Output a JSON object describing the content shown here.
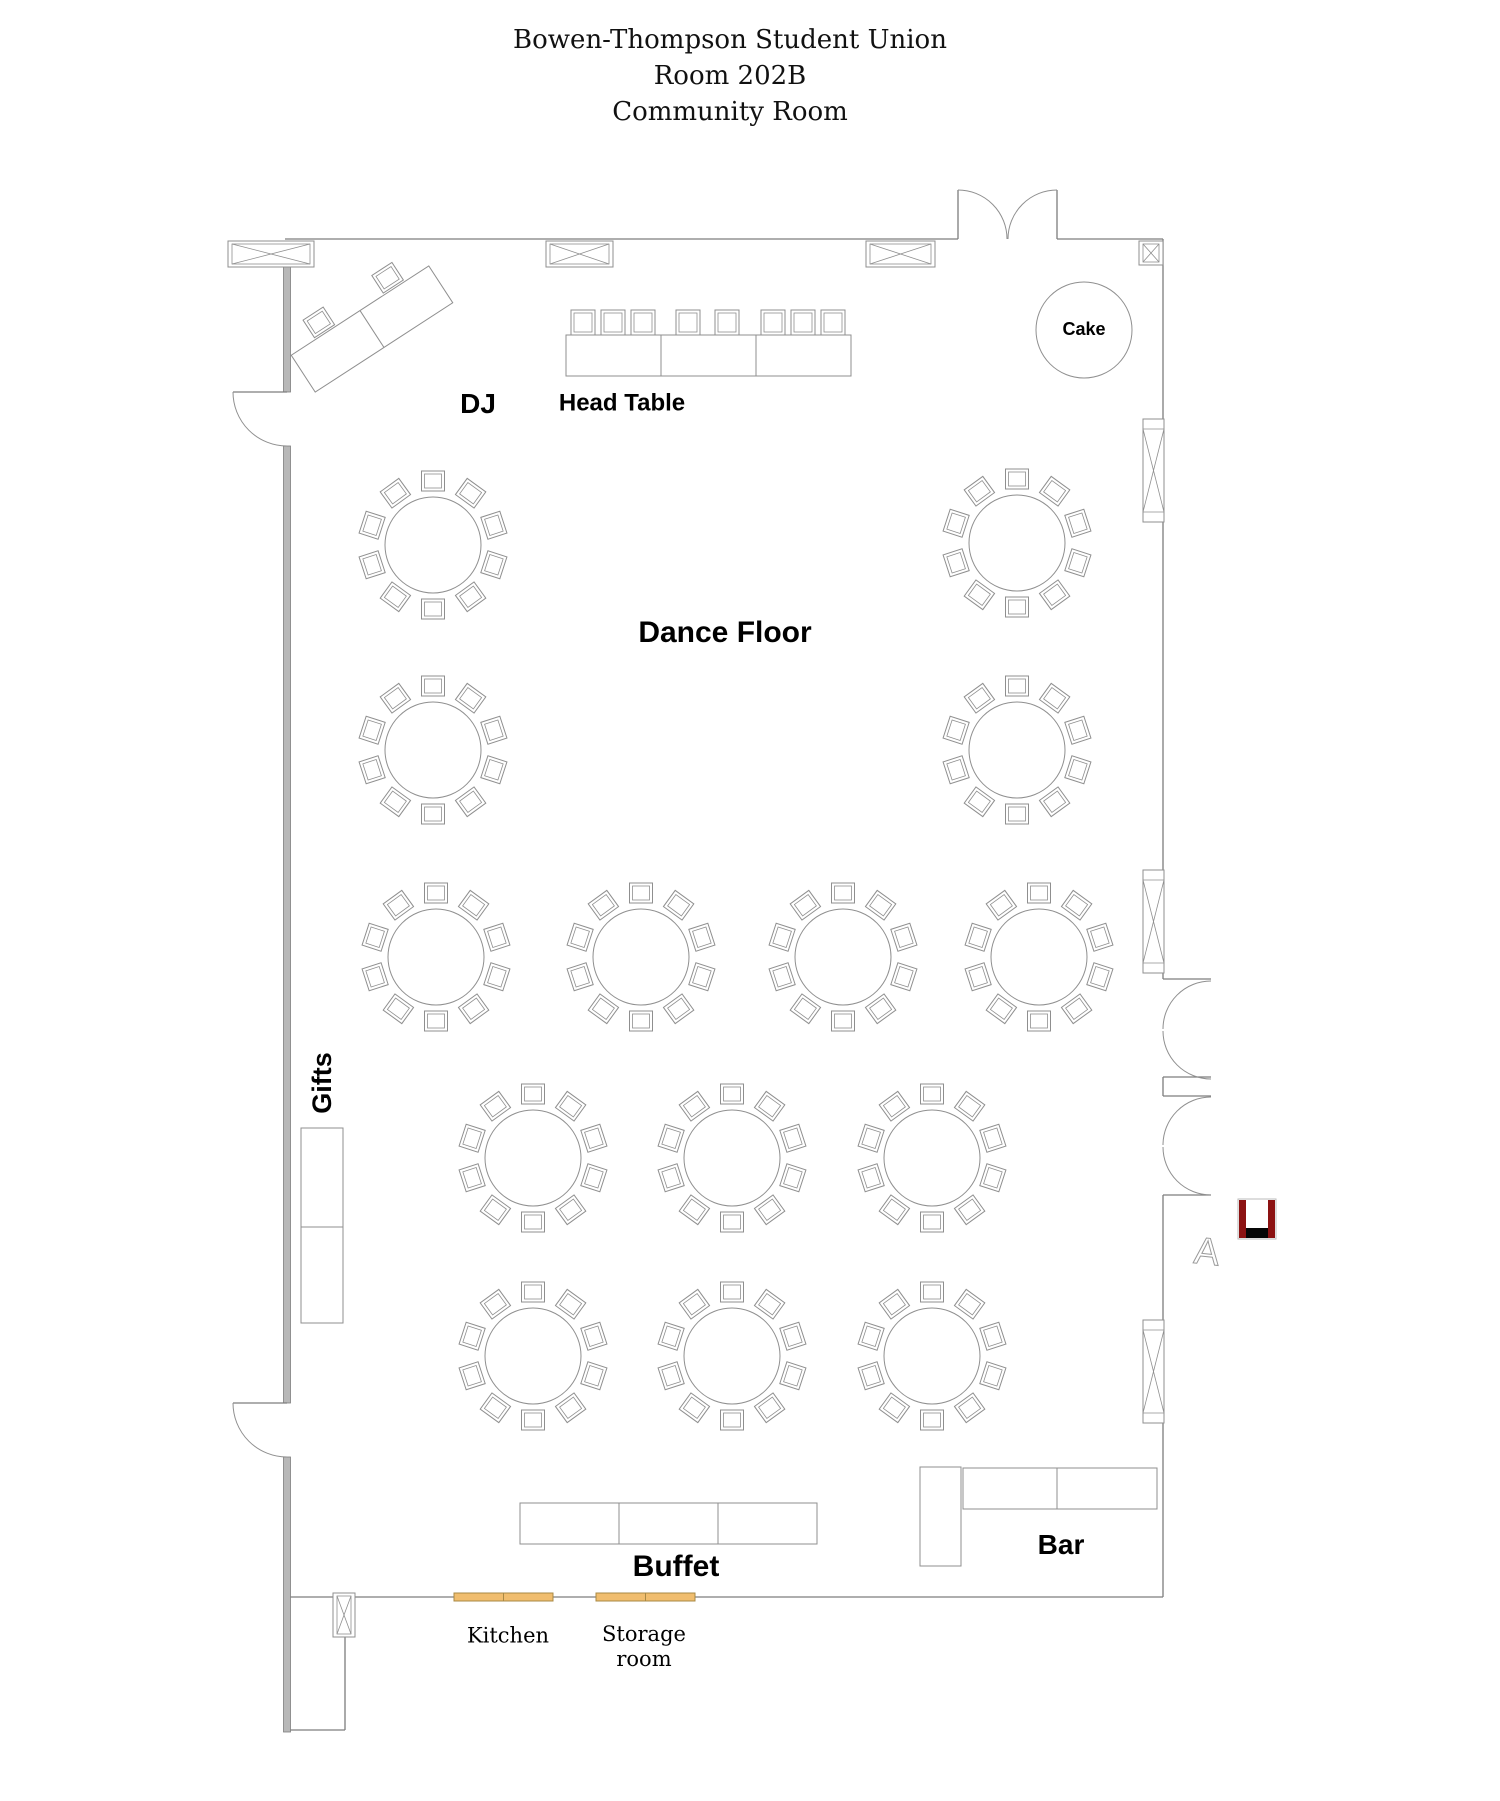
{
  "title": {
    "line1": "Bowen-Thompson Student Union",
    "line2": "Room 202B",
    "line3": "Community Room"
  },
  "labels": {
    "dj": "DJ",
    "head_table": "Head Table",
    "cake": "Cake",
    "dance_floor": "Dance Floor",
    "gifts": "Gifts",
    "buffet": "Buffet",
    "bar": "Bar",
    "kitchen": "Kitchen",
    "storage_room": "Storage\nroom",
    "a_marker_glyph": "A"
  },
  "colors": {
    "furniture_stroke": "#8f8f8f",
    "wall_stroke": "#7d7d7d",
    "thick_wall_fill": "#b8b8b8",
    "kitchen_door_fill": "#f0bd6e",
    "kitchen_door_border": "#a98944",
    "exit_marker_red": "#8c1212",
    "exit_marker_black": "#060606",
    "a_marker_color": "#9a9a9a"
  },
  "floor_plan": {
    "walls": [
      [
        285,
        239,
        958,
        239
      ],
      [
        1057,
        239,
        1163,
        239
      ],
      [
        1163,
        239,
        1163,
        979
      ],
      [
        1163,
        979,
        1211,
        979
      ],
      [
        1163,
        1077,
        1211,
        1077
      ],
      [
        1163,
        1077,
        1163,
        1096
      ],
      [
        1163,
        1096,
        1211,
        1096
      ],
      [
        1211,
        1195,
        1163,
        1195
      ],
      [
        1163,
        1195,
        1163,
        1597
      ],
      [
        1163,
        1597,
        288,
        1597
      ],
      [
        345,
        1637,
        345,
        1730
      ],
      [
        345,
        1730,
        288,
        1730
      ]
    ],
    "thick_wall": {
      "x": 283.5,
      "w": 7,
      "segments": [
        [
          267,
          392
        ],
        [
          446,
          1403
        ],
        [
          1457,
          1732
        ]
      ]
    },
    "columns": [
      {
        "x": 228,
        "y": 241,
        "w": 86,
        "h": 26
      },
      {
        "x": 546,
        "y": 241,
        "w": 67,
        "h": 26
      },
      {
        "x": 866,
        "y": 241,
        "w": 69,
        "h": 26
      },
      {
        "x": 1139,
        "y": 241,
        "w": 24,
        "h": 24
      },
      {
        "x": 333,
        "y": 1593,
        "w": 22,
        "h": 44
      }
    ],
    "windows": [
      {
        "x": 1143,
        "y": 419,
        "w": 21,
        "h": 103
      },
      {
        "x": 1143,
        "y": 870,
        "w": 21,
        "h": 103
      },
      {
        "x": 1143,
        "y": 1320,
        "w": 21,
        "h": 103
      }
    ],
    "door_lines": [
      [
        958,
        190,
        958,
        239
      ],
      [
        1057,
        190,
        1057,
        239
      ],
      [
        233,
        392,
        287,
        392
      ],
      [
        233,
        1403,
        287,
        1403
      ]
    ],
    "door_arcs": [
      "M958 190A49 49 0 0 1 1007 239",
      "M1057 190A49 49 0 0 0 1008 239",
      "M1211 981A48 48 0 0 0 1163 1029",
      "M1163 1031A48 48 0 0 0 1211 1079",
      "M1211 1097A48 48 0 0 0 1163 1145",
      "M1163 1147A48 48 0 0 0 1211 1195",
      "M233 392A54 54 0 0 0 287 446",
      "M233 1403A54 54 0 0 0 287 1457"
    ],
    "kitchen_doors": [
      {
        "x": 454,
        "y": 1593,
        "w": 99,
        "h": 8
      },
      {
        "x": 596,
        "y": 1593,
        "w": 99,
        "h": 8
      }
    ],
    "round_tables": {
      "radius": 48,
      "chair_count": 10,
      "chair_w": 23,
      "chair_h": 20,
      "chair_gap": 6,
      "centers": [
        [
          433,
          545
        ],
        [
          1017,
          543
        ],
        [
          433,
          750
        ],
        [
          1017,
          750
        ],
        [
          436,
          957
        ],
        [
          641,
          957
        ],
        [
          843,
          957
        ],
        [
          1039,
          957
        ],
        [
          533,
          1158
        ],
        [
          732,
          1158
        ],
        [
          932,
          1158
        ],
        [
          533,
          1356
        ],
        [
          732,
          1356
        ],
        [
          932,
          1356
        ]
      ]
    },
    "head_table": {
      "x": 566,
      "y": 335,
      "w": 285,
      "h": 41,
      "dividers": [
        661,
        756
      ],
      "chair_y": 310,
      "chair_w": 24,
      "chair_h": 25,
      "chair_xs": [
        571,
        601,
        631,
        676,
        715,
        761,
        791,
        821
      ]
    },
    "dj_table": {
      "cx": 372,
      "cy": 329,
      "len": 164,
      "wid": 44,
      "angle": -33,
      "chair_offsets": [
        -41,
        41
      ],
      "chair_w": 24,
      "chair_h": 21
    },
    "cake_table": {
      "cx": 1084,
      "cy": 330,
      "r": 48
    },
    "gifts_table": {
      "x": 301,
      "y": 1128,
      "w": 42,
      "h": 195,
      "dividers_y": [
        1227
      ]
    },
    "buffet_table": {
      "x": 520,
      "y": 1503,
      "w": 297,
      "h": 41,
      "dividers": [
        619,
        718
      ]
    },
    "bar": {
      "vertical": {
        "x": 920,
        "y": 1467,
        "w": 41,
        "h": 99
      },
      "horizontal": {
        "x": 963,
        "y": 1468,
        "w": 194,
        "h": 41,
        "dividers": [
          1057
        ]
      }
    },
    "exit_marker": {
      "x": 1239,
      "y": 1200,
      "w": 36,
      "h": 38,
      "bar_w": 7,
      "bottom_h": 10
    },
    "a_marker": {
      "x": 1207,
      "y": 1251,
      "size": 38,
      "angle": 6
    }
  },
  "label_positions": {
    "title1": [
      730,
      40
    ],
    "title2": [
      730,
      76
    ],
    "title3": [
      730,
      112
    ],
    "dj": [
      478,
      404
    ],
    "head_table": [
      622,
      404
    ],
    "dance_floor": [
      725,
      633
    ],
    "cake": [
      1084,
      330
    ],
    "gifts": [
      322,
      1083
    ],
    "buffet": [
      676,
      1567
    ],
    "bar": [
      1061,
      1545
    ],
    "kitchen": [
      508,
      1636
    ],
    "storage_room": [
      644,
      1647
    ]
  }
}
